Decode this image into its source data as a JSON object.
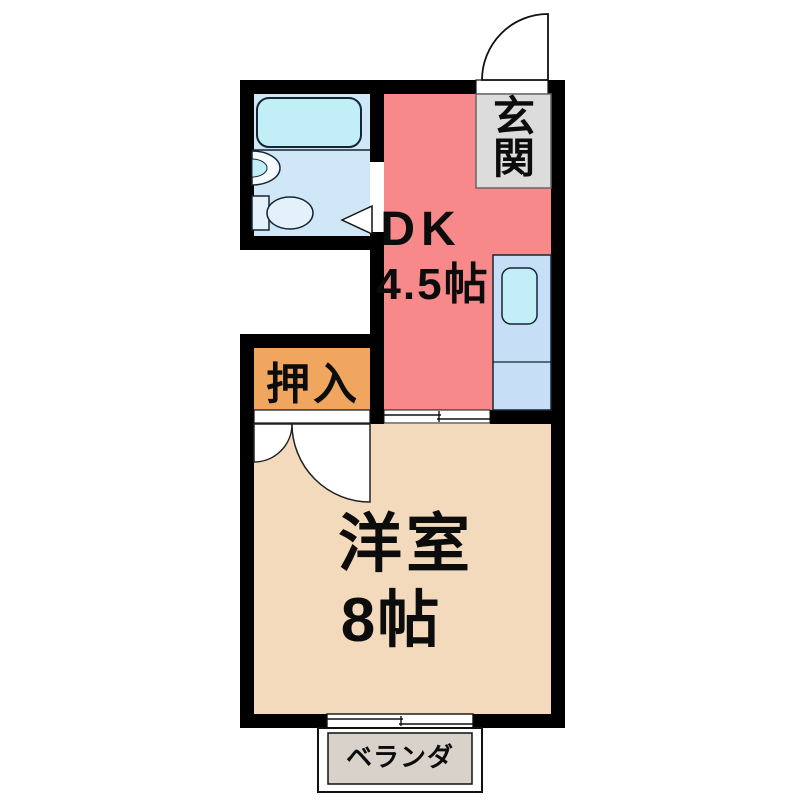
{
  "floorplan": {
    "rooms": {
      "genkan": {
        "label": "玄関",
        "chars": [
          "玄",
          "関"
        ]
      },
      "dk": {
        "label": "DK",
        "size": "4.5帖"
      },
      "oshiire": {
        "label": "押入"
      },
      "western_room": {
        "label": "洋室",
        "size": "8帖"
      },
      "veranda": {
        "label": "ベランダ"
      }
    },
    "colors": {
      "wall": "#000000",
      "background": "#ffffff",
      "dk_floor": "#F8898B",
      "western_floor": "#F3DABC",
      "oshiire_floor": "#F0A65E",
      "bathroom_floor": "#CFE7F7",
      "fixture_cyan": "#C2EEF7",
      "kitchen_counter": "#C6DEF6",
      "toilet_fill": "#E4F1FB",
      "basin_fill": "#F4FAFE",
      "genkan_box": "#DCDCDC",
      "veranda_box": "#D8D2CB",
      "opening_white": "#FFFFFF"
    }
  }
}
